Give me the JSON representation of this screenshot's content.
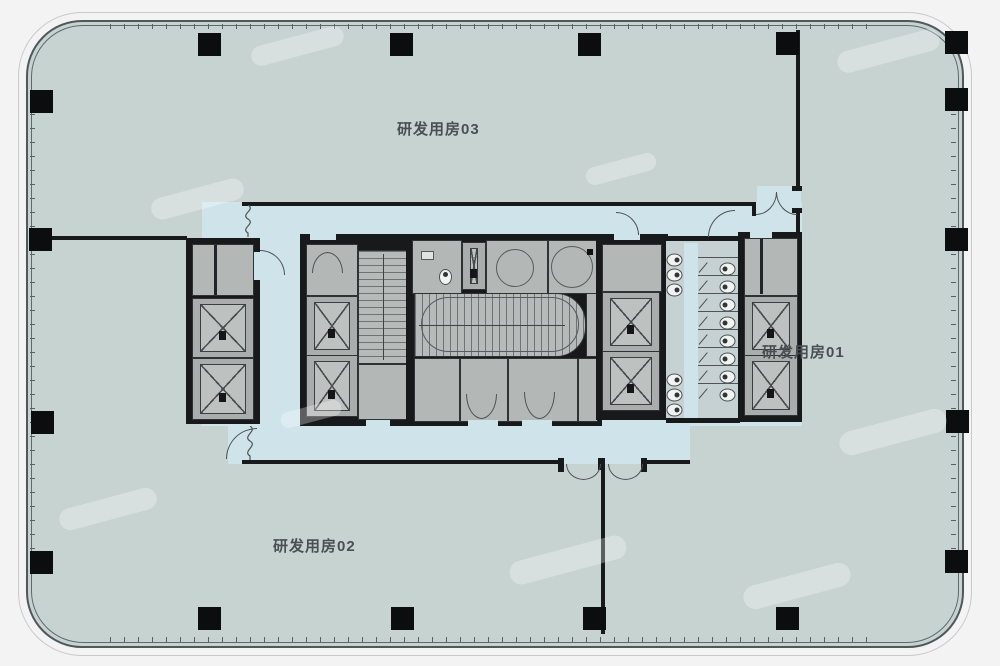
{
  "floorplan": {
    "title_visible": false,
    "areas": {
      "room03": "研发用房03",
      "room01": "研发用房01",
      "room02": "研发用房02"
    },
    "core": {
      "elevator_count": 8,
      "service_shaft_count": 2,
      "staircase_count": 2,
      "toilet_stall_count": 8,
      "toilet_fixture_count": 6
    },
    "structure": {
      "perimeter_column_count": 17,
      "outline": "rounded-rectangle curtain wall with mullion ticks"
    },
    "colors": {
      "background": "#f2f3f2",
      "floor": "#c7d3d1",
      "corridor": "#cfe4ea",
      "core_room": "#b3b8b7",
      "wall": "#17191b",
      "column": "#0b0d0e",
      "outline": "#5f696c",
      "label_text": "#4a4f52"
    }
  }
}
